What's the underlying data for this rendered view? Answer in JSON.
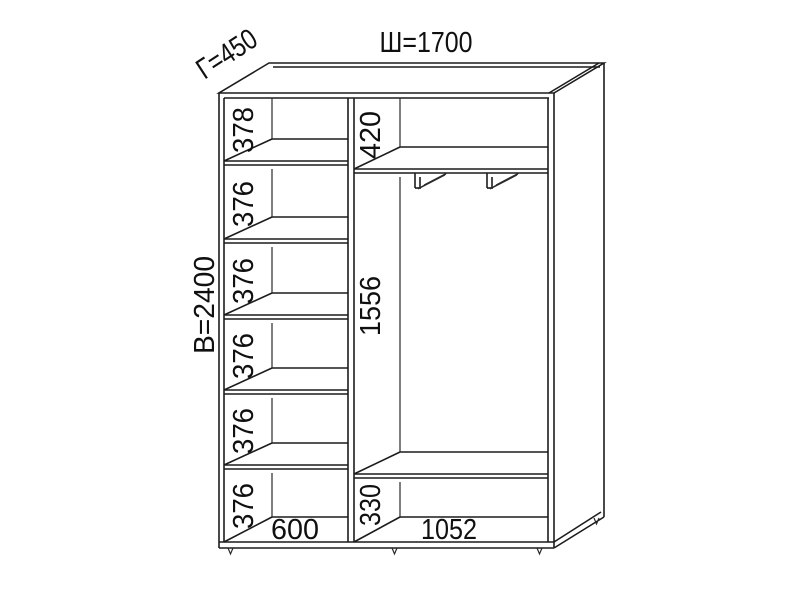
{
  "diagram": {
    "overall_dimensions": {
      "width": "Ш=1700",
      "depth": "Г=450",
      "height": "В=2400"
    },
    "left_column": {
      "sections": [
        "378",
        "376",
        "376",
        "376",
        "376",
        "376"
      ],
      "width": "600"
    },
    "right_column": {
      "top_section": "420",
      "hanging_section": "1556",
      "bottom_section": "330",
      "width": "1052"
    }
  }
}
